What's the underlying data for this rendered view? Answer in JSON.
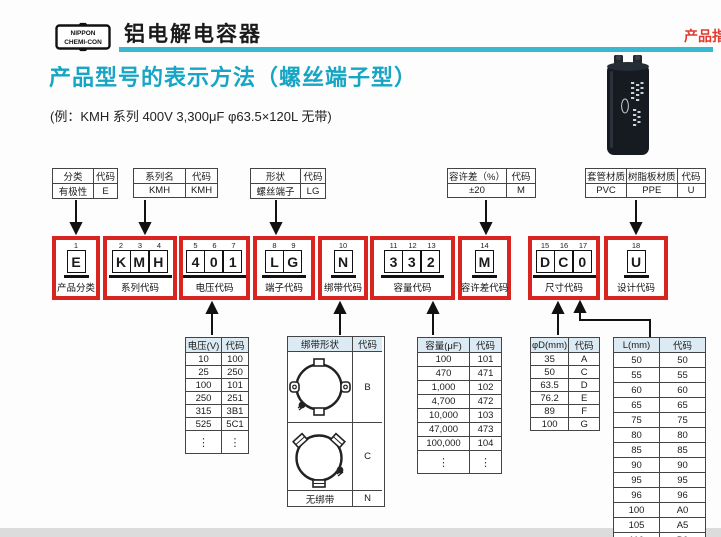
{
  "page": {
    "logo_line1": "NIPPON",
    "logo_line2": "CHEMI-CON",
    "product_title": "铝电解电容器",
    "corner_label": "产品指",
    "heading": "产品型号的表示方法（螺丝端子型）",
    "example": "(例：KMH 系列 400V 3,300μF  φ63.5×120L 无带)"
  },
  "colors": {
    "teal": "#16a5c4",
    "rule": "#3ab8d2",
    "red": "#d9251f",
    "corner_red": "#e23a2e",
    "table_header_bg": "#dbeaf3"
  },
  "spec_labels": [
    {
      "headers": [
        "分类",
        "代码"
      ],
      "rows": [
        [
          "有极性",
          "E"
        ]
      ]
    },
    {
      "headers": [
        "系列名",
        "代码"
      ],
      "rows": [
        [
          "KMH",
          "KMH"
        ]
      ]
    },
    {
      "headers": [
        "形状",
        "代码"
      ],
      "rows": [
        [
          "螺丝端子",
          "LG"
        ]
      ]
    },
    {
      "headers": [
        "容许差（%）",
        "代码"
      ],
      "rows": [
        [
          "±20",
          "M"
        ]
      ]
    },
    {
      "headers": [
        "套管材质",
        "树脂板材质",
        "代码"
      ],
      "rows": [
        [
          "PVC",
          "PPE",
          "U"
        ]
      ]
    }
  ],
  "code_boxes": [
    {
      "positions": [
        "1"
      ],
      "chars": [
        "E"
      ],
      "label": "产品分类"
    },
    {
      "positions": [
        "2",
        "3",
        "4"
      ],
      "chars": [
        "K",
        "M",
        "H"
      ],
      "label": "系列代码"
    },
    {
      "positions": [
        "5",
        "6",
        "7"
      ],
      "chars": [
        "4",
        "0",
        "1"
      ],
      "label": "电压代码"
    },
    {
      "positions": [
        "8",
        "9"
      ],
      "chars": [
        "L",
        "G"
      ],
      "label": "端子代码"
    },
    {
      "positions": [
        "10"
      ],
      "chars": [
        "N"
      ],
      "label": "绑带代码"
    },
    {
      "positions": [
        "11",
        "12",
        "13"
      ],
      "chars": [
        "3",
        "3",
        "2"
      ],
      "label": "容量代码"
    },
    {
      "positions": [
        "14"
      ],
      "chars": [
        "M"
      ],
      "label": "容许差代码"
    },
    {
      "positions": [
        "15",
        "16",
        "17"
      ],
      "chars": [
        "D",
        "C",
        "0"
      ],
      "label": "尺寸代码"
    },
    {
      "positions": [
        "18"
      ],
      "chars": [
        "U"
      ],
      "label": "设计代码"
    }
  ],
  "voltage_table": {
    "headers": [
      "电压(V)",
      "代码"
    ],
    "rows": [
      [
        "10",
        "100"
      ],
      [
        "25",
        "250"
      ],
      [
        "100",
        "101"
      ],
      [
        "250",
        "251"
      ],
      [
        "315",
        "3B1"
      ],
      [
        "525",
        "5C1"
      ],
      [
        "⋮",
        "⋮"
      ]
    ]
  },
  "band_table": {
    "headers": [
      "绑带形状",
      "代码"
    ],
    "rows": [
      {
        "shape": "band-clamp-style-b",
        "code": "B"
      },
      {
        "shape": "band-clamp-style-c",
        "code": "C"
      },
      {
        "label": "无绑带",
        "code": "N"
      }
    ]
  },
  "capacitance_table": {
    "headers": [
      "容量(μF)",
      "代码"
    ],
    "rows": [
      [
        "100",
        "101"
      ],
      [
        "470",
        "471"
      ],
      [
        "1,000",
        "102"
      ],
      [
        "4,700",
        "472"
      ],
      [
        "10,000",
        "103"
      ],
      [
        "47,000",
        "473"
      ],
      [
        "100,000",
        "104"
      ],
      [
        "⋮",
        "⋮"
      ]
    ]
  },
  "diameter_table": {
    "headers": [
      "φD(mm)",
      "代码"
    ],
    "rows": [
      [
        "35",
        "A"
      ],
      [
        "50",
        "C"
      ],
      [
        "63.5",
        "D"
      ],
      [
        "76.2",
        "E"
      ],
      [
        "89",
        "F"
      ],
      [
        "100",
        "G"
      ]
    ]
  },
  "length_table": {
    "headers": [
      "L(mm)",
      "代码"
    ],
    "rows": [
      [
        "50",
        "50"
      ],
      [
        "55",
        "55"
      ],
      [
        "60",
        "60"
      ],
      [
        "65",
        "65"
      ],
      [
        "75",
        "75"
      ],
      [
        "80",
        "80"
      ],
      [
        "85",
        "85"
      ],
      [
        "90",
        "90"
      ],
      [
        "95",
        "95"
      ],
      [
        "96",
        "96"
      ],
      [
        "100",
        "A0"
      ],
      [
        "105",
        "A5"
      ],
      [
        "110",
        "B0"
      ]
    ]
  }
}
